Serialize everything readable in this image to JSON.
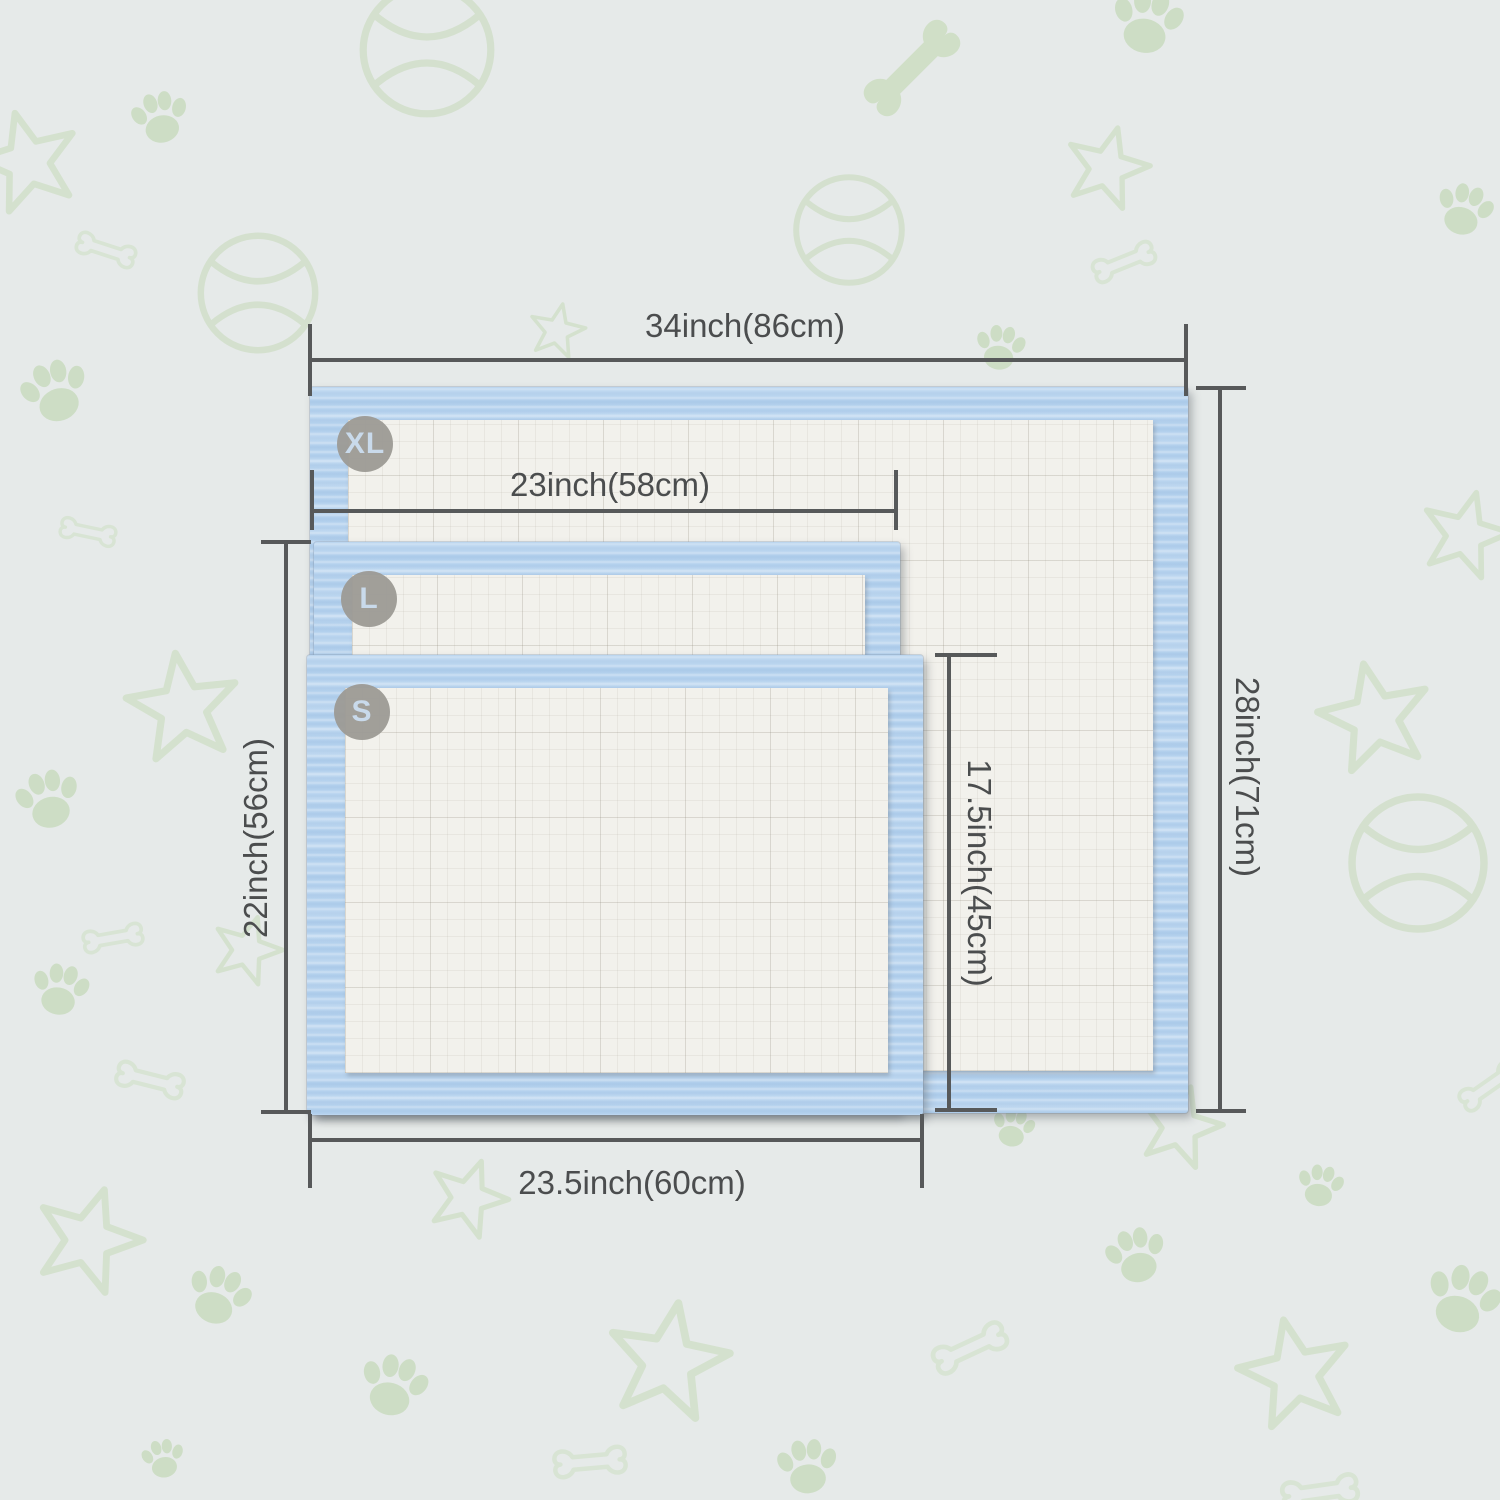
{
  "diagram": {
    "kind": "pet-pad-size-comparison",
    "sizes": [
      {
        "badge": "XL",
        "width": "34inch(86cm)",
        "height": "28inch(71cm)"
      },
      {
        "badge": "L",
        "width": "23inch(58cm)",
        "height": "22inch(56cm)"
      },
      {
        "badge": "S",
        "width": "23.5inch(60cm)",
        "height": "17.5inch(45cm)"
      }
    ],
    "colors": {
      "background": "#e6eae9",
      "pad_border_blue": "#b5d2ee",
      "pad_core_white": "#f2f1ec",
      "dimension_line": "#57595a",
      "label_text": "#4b4d4e",
      "badge_background": "#9c9a95",
      "badge_text": "#c9daeb",
      "pattern_green": "#c3d8b5"
    },
    "pattern_icons": [
      "tennis-ball",
      "bone",
      "paw-print",
      "star"
    ]
  },
  "sizes": [
    {
      "badge": "XL",
      "width": "34inch(86cm)",
      "height": "28inch(71cm)"
    },
    {
      "badge": "L",
      "width": "23inch(58cm)",
      "height": "22inch(56cm)"
    },
    {
      "badge": "S",
      "width": "23.5inch(60cm)",
      "height": "17.5inch(45cm)"
    }
  ]
}
